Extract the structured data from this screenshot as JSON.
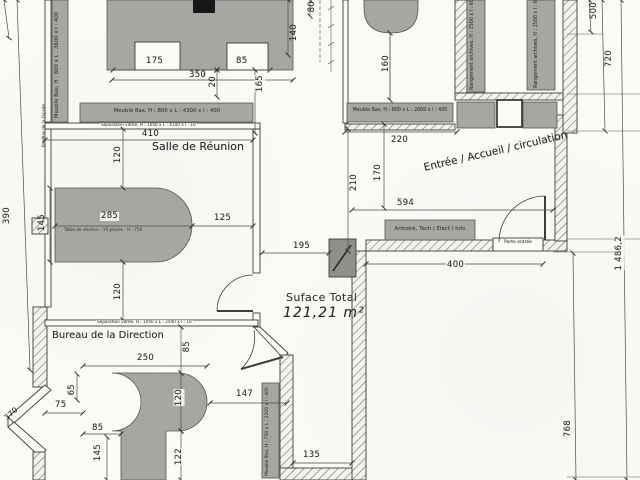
{
  "plan": {
    "surface_label": "Suface Total",
    "surface_value": "121,21 m²",
    "rooms": {
      "meeting": "Salle de Réunion",
      "office": "Bureau de la Direction",
      "entry": "Entrée / Accueil / circulation"
    },
    "annotations": {
      "cabinet_left": "Meuble Bas, H : 800 x L : 3800 x l : 400",
      "cabinet_top": "Meuble Bas, H : 800 x L : 4300 x l : 400",
      "cabinet_entry": "Meuble Bas, H : 800 x L : 2000 x l : 400",
      "cabinet_office": "Meuble Bas, H : 750 x L : 2200 x l : 400",
      "archives_a": "Rangement archives, H : 2500 x l : 600",
      "archives_b": "Rangement archives, H : 2500 x l : 600",
      "tech_cabinet": "Armoire, Tech / Elect / Info",
      "entry_door": "Porte entrée",
      "meeting_table": "Table de réunion - 10 places - H : 750",
      "partition_meeting": "Séparation vitrée, H : 1050 x L : 4100 x l : 10",
      "partition_office": "Séparation vitrée, H : 1050 x L : 2500 x l : 10",
      "window_left": "Fenêtre de la façade"
    },
    "dims": {
      "d175": "175",
      "d85a": "85",
      "d350": "350",
      "d20": "20",
      "d140": "140",
      "d80": "80",
      "d165": "165",
      "d410": "410",
      "d120a": "120",
      "d145t": "145",
      "d285": "285",
      "d125": "125",
      "d390": "390",
      "d120b": "120",
      "d195": "195",
      "d160": "160",
      "d220": "220",
      "d210": "210",
      "d170": "170",
      "d594": "594",
      "d400": "400",
      "d500": "500",
      "d720": "720",
      "d1486": "1 486,2",
      "d768": "768",
      "d85b": "85",
      "d250": "250",
      "d75": "75",
      "d65": "65",
      "d120c": "120",
      "d147": "147",
      "d85c": "85",
      "d145": "145",
      "d122": "122",
      "d135": "135",
      "d370": "370"
    },
    "colors": {
      "furniture": "#a6a6a3",
      "line": "#3c3c3c",
      "paper": "#fbfaf7",
      "dark_block": "#8f8f8c"
    }
  }
}
